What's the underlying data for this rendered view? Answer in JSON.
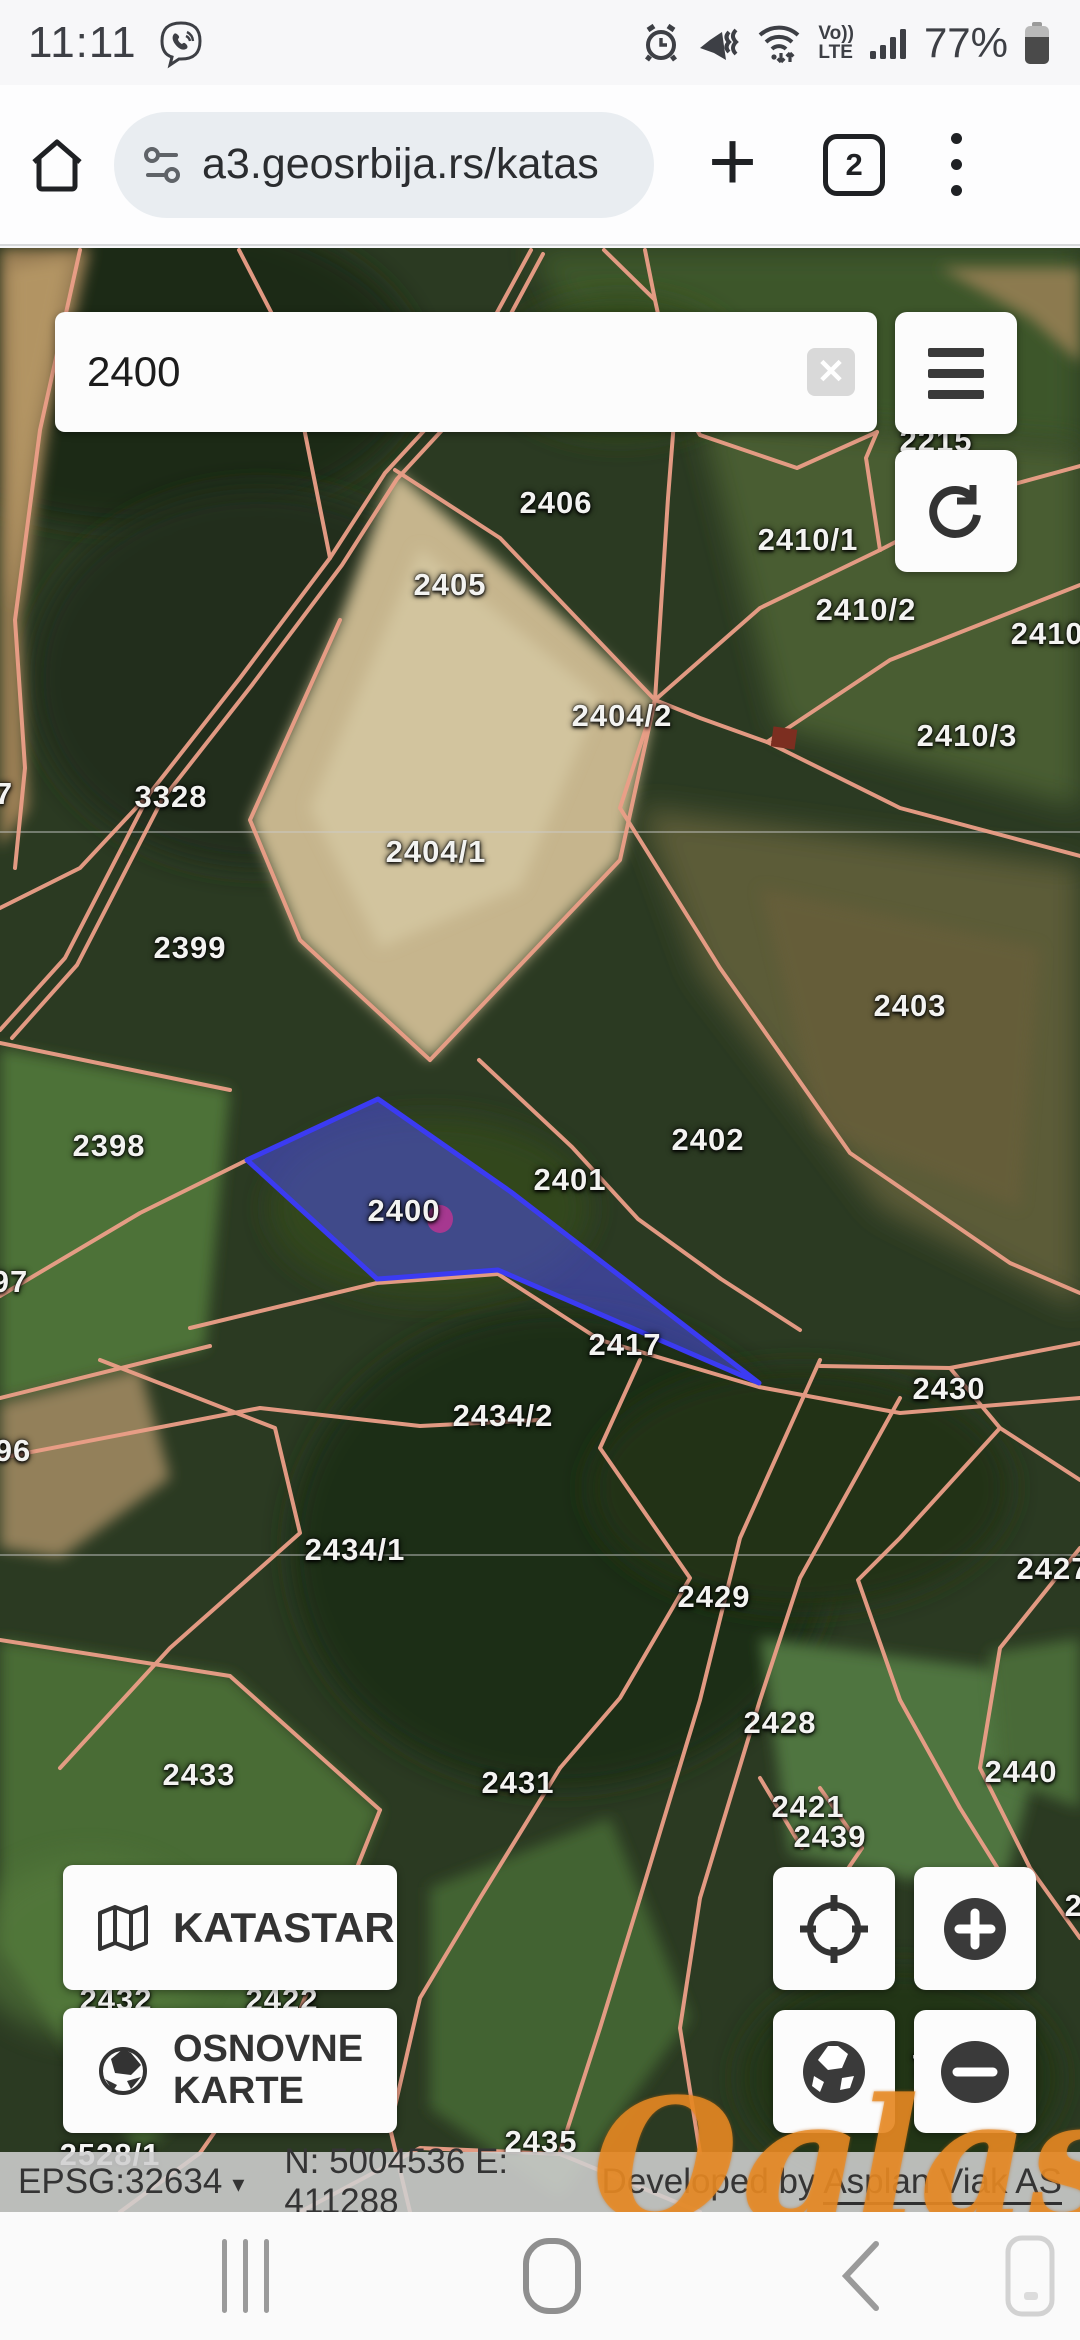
{
  "status_bar": {
    "time": "11:11",
    "battery_percent": "77%",
    "volte_top": "Vo))",
    "volte_bottom": "LTE"
  },
  "browser": {
    "url": "a3.geosrbija.rs/katas",
    "tab_count": "2"
  },
  "map": {
    "search": {
      "value": "2400",
      "clear_glyph": "✕"
    },
    "controls": {
      "katastar_label": "KATASTAR",
      "osnovne_line1": "OSNOVNE",
      "osnovne_line2": "KARTE"
    },
    "selected_parcel": {
      "label": "2400",
      "fill": "#4d4df0",
      "stroke": "#3b3bf2",
      "marker_color": "#a63890"
    },
    "colors": {
      "boundary_line": "#ec9f88",
      "label_text": "#f3f3f1"
    },
    "labels": [
      {
        "text": "2215",
        "x": 936,
        "y": 193
      },
      {
        "text": "2406",
        "x": 556,
        "y": 255
      },
      {
        "text": "2410/1",
        "x": 808,
        "y": 292
      },
      {
        "text": "2405",
        "x": 450,
        "y": 337
      },
      {
        "text": "2410/2",
        "x": 866,
        "y": 362
      },
      {
        "text": "2410/",
        "x": 1052,
        "y": 386
      },
      {
        "text": "2404/2",
        "x": 622,
        "y": 468
      },
      {
        "text": "2410/3",
        "x": 967,
        "y": 488
      },
      {
        "text": "3328",
        "x": 171,
        "y": 549
      },
      {
        "text": "7",
        "x": 4,
        "y": 546
      },
      {
        "text": "2404/1",
        "x": 436,
        "y": 604
      },
      {
        "text": "2399",
        "x": 190,
        "y": 700
      },
      {
        "text": "2403",
        "x": 910,
        "y": 758
      },
      {
        "text": "2402",
        "x": 708,
        "y": 892
      },
      {
        "text": "2398",
        "x": 109,
        "y": 898
      },
      {
        "text": "2401",
        "x": 570,
        "y": 932
      },
      {
        "text": "2400",
        "x": 404,
        "y": 963
      },
      {
        "text": "97",
        "x": 10,
        "y": 1034
      },
      {
        "text": "2417",
        "x": 625,
        "y": 1097
      },
      {
        "text": "2430",
        "x": 949,
        "y": 1141
      },
      {
        "text": "2434/2",
        "x": 503,
        "y": 1168
      },
      {
        "text": "96",
        "x": 13,
        "y": 1203
      },
      {
        "text": "2434/1",
        "x": 355,
        "y": 1302
      },
      {
        "text": "2427",
        "x": 1053,
        "y": 1321
      },
      {
        "text": "2429",
        "x": 714,
        "y": 1349
      },
      {
        "text": "2428",
        "x": 780,
        "y": 1475
      },
      {
        "text": "2440",
        "x": 1021,
        "y": 1524
      },
      {
        "text": "2433",
        "x": 199,
        "y": 1527
      },
      {
        "text": "2431",
        "x": 518,
        "y": 1535
      },
      {
        "text": "2421",
        "x": 808,
        "y": 1559
      },
      {
        "text": "2439",
        "x": 830,
        "y": 1589
      },
      {
        "text": "244",
        "x": 1092,
        "y": 1658
      },
      {
        "text": "2432",
        "x": 116,
        "y": 1752
      },
      {
        "text": "2422",
        "x": 282,
        "y": 1752
      },
      {
        "text": "7",
        "x": 921,
        "y": 1818
      },
      {
        "text": "2435",
        "x": 541,
        "y": 1894
      },
      {
        "text": "2528/1",
        "x": 110,
        "y": 1907
      }
    ]
  },
  "coord_bar": {
    "epsg": "EPSG:32634",
    "caret": "▾",
    "coordinates": "N: 5004536 E: 411288",
    "credit_prefix": "Developed by ",
    "credit_link": "Asplan Viak AS"
  },
  "watermark": {
    "text": "Oglasi",
    "color": "#e98b24"
  }
}
